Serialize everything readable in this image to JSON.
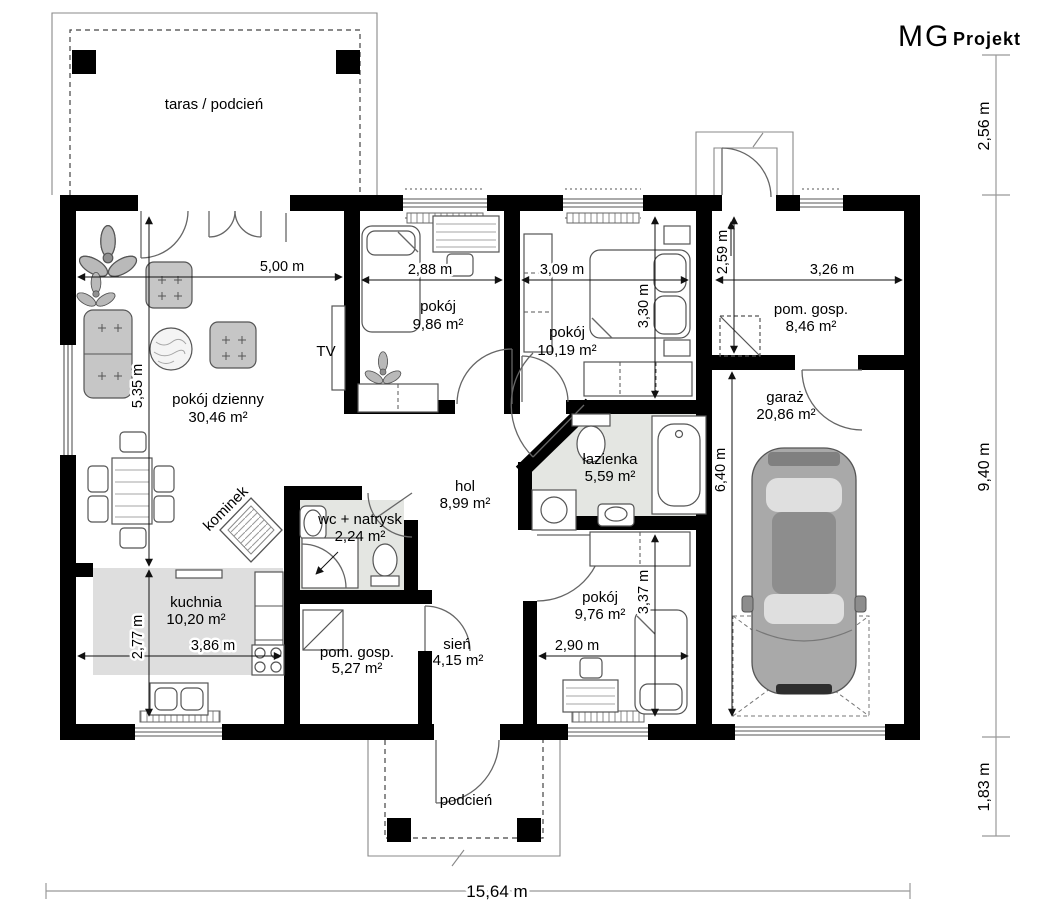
{
  "brand": {
    "name_primary": "MG",
    "name_secondary": "Projekt"
  },
  "rooms": [
    {
      "name": "taras / podcień",
      "area": ""
    },
    {
      "name": "pokój dzienny",
      "area": "30,46 m²"
    },
    {
      "name": "pokój",
      "area": "9,86 m²"
    },
    {
      "name": "pokój",
      "area": "10,19 m²"
    },
    {
      "name": "pom. gosp.",
      "area": "8,46 m²"
    },
    {
      "name": "garaż",
      "area": "20,86 m²"
    },
    {
      "name": "łazienka",
      "area": "5,59 m²"
    },
    {
      "name": "hol",
      "area": "8,99 m²"
    },
    {
      "name": "wc + natrysk",
      "area": "2,24 m²"
    },
    {
      "name": "kuchnia",
      "area": "10,20 m²"
    },
    {
      "name": "pom. gosp.",
      "area": "5,27 m²"
    },
    {
      "name": "sień",
      "area": "4,15 m²"
    },
    {
      "name": "pokój",
      "area": "9,76 m²"
    },
    {
      "name": "podcień",
      "area": ""
    }
  ],
  "annotations": {
    "tv_label": "TV",
    "fireplace_label": "kominek"
  },
  "dimensions": {
    "interior": {
      "living_width": "5,00 m",
      "living_height": "5,35 m",
      "room1_width": "2,88 m",
      "room2_width": "3,09 m",
      "utility_top_width": "3,26 m",
      "utility_top_height": "2,59 m",
      "room2_height": "3,30 m",
      "garage_height": "6,40 m",
      "kitchen_height": "2,77 m",
      "kitchen_width": "3,86 m",
      "room3_width": "2,90 m",
      "room3_height": "3,37 m"
    },
    "exterior": {
      "right_top": "2,56 m",
      "right_middle": "9,40 m",
      "right_bottom": "1,83 m",
      "bottom_total": "15,64 m"
    }
  }
}
